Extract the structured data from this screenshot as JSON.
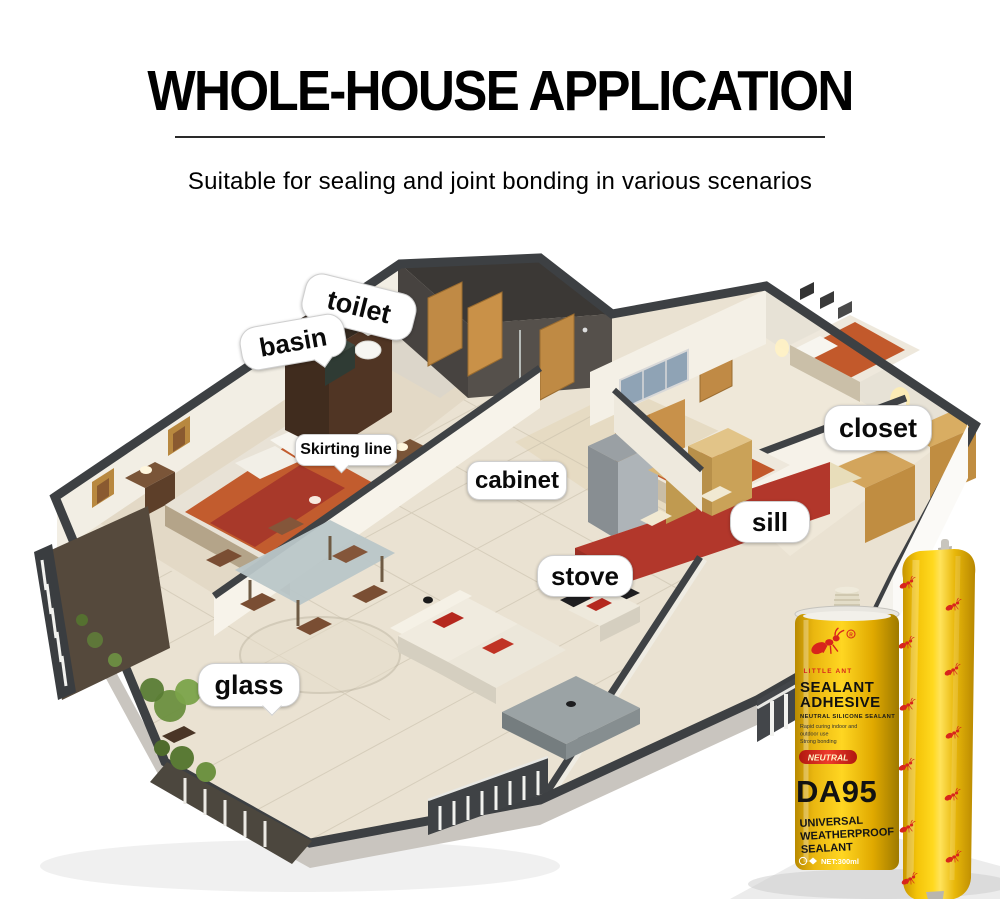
{
  "header": {
    "title": "WHOLE-HOUSE APPLICATION",
    "subtitle": "Suitable for sealing and joint bonding in various scenarios"
  },
  "house": {
    "labels": [
      {
        "id": "toilet",
        "text": "toilet"
      },
      {
        "id": "basin",
        "text": "basin"
      },
      {
        "id": "skirting",
        "text": "Skirting line"
      },
      {
        "id": "cabinet",
        "text": "cabinet"
      },
      {
        "id": "closet",
        "text": "closet"
      },
      {
        "id": "sill",
        "text": "sill"
      },
      {
        "id": "stove",
        "text": "stove"
      },
      {
        "id": "glass",
        "text": "glass"
      }
    ]
  },
  "product": {
    "brand": "LITTLE ANT",
    "name_line1": "SEALANT",
    "name_line2": "ADHESIVE",
    "type_line": "NEUTRAL SILICONE SEALANT",
    "desc_line1": "Rapid curing indoor and",
    "desc_line2": "outdoor use",
    "desc_line3": "Strong bonding",
    "badge": "NEUTRAL",
    "model": "DA95",
    "footer_line1": "UNIVERSAL",
    "footer_line2": "WEATHERPROOF",
    "footer_line3": "SEALANT",
    "net": "NET:300ml",
    "colors": {
      "body_yellow": "#f6c50d",
      "logo_red": "#d8251c",
      "badge_red": "#e02a20",
      "text_black": "#141414"
    }
  }
}
